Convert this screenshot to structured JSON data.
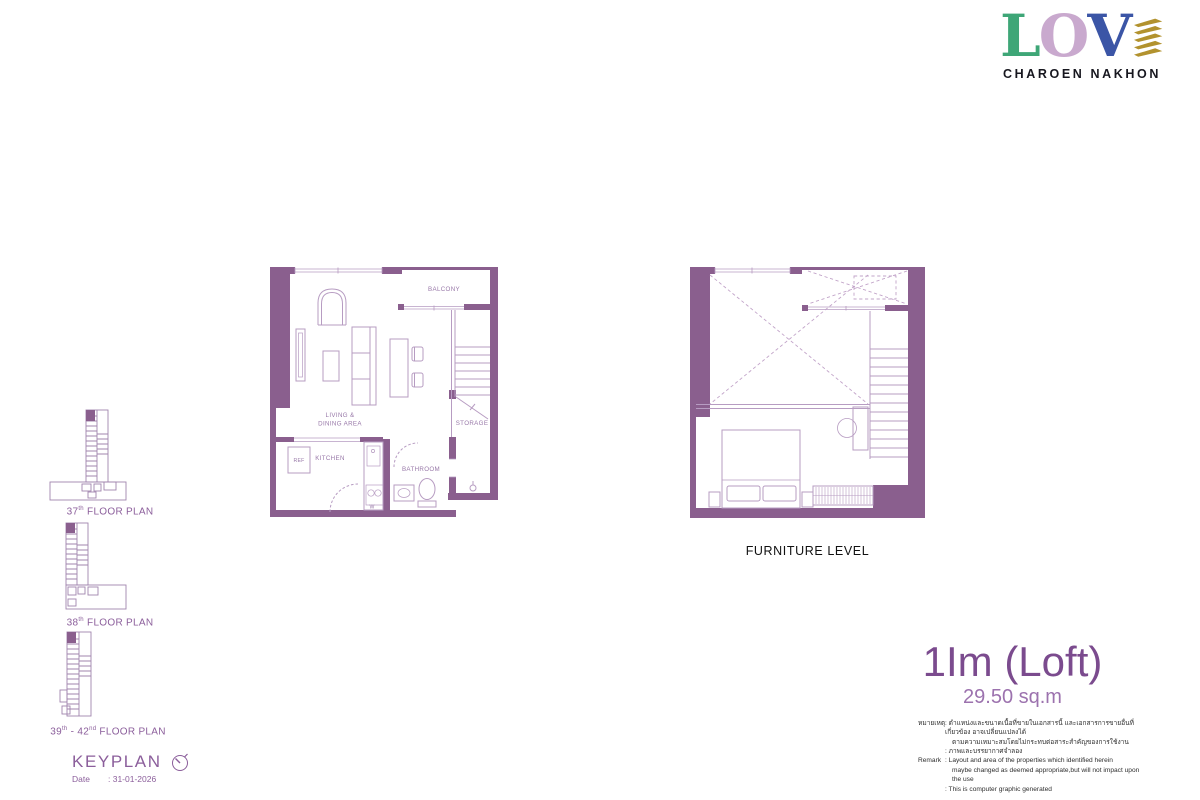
{
  "logo": {
    "letters": [
      {
        "char": "L",
        "color": "#3EA677"
      },
      {
        "char": "O",
        "color": "#C9A9CE"
      },
      {
        "char": "V",
        "color": "#3B55A6"
      }
    ],
    "leaf_color": "#B2922E",
    "subtitle": "CHAROEN NAKHON"
  },
  "unit_plan": {
    "wall_color": "#8A5F8E",
    "line_color": "#B79CC2",
    "labels": {
      "balcony": "BALCONY",
      "living_line1": "LIVING &",
      "living_line2": "DINING AREA",
      "storage": "STORAGE",
      "kitchen": "KITCHEN",
      "ref": "REF",
      "washer": "W",
      "bathroom": "BATHROOM"
    }
  },
  "furniture_plan": {
    "caption": "FURNITURE LEVEL"
  },
  "keyplans": [
    {
      "parts": [
        {
          "text": "37"
        },
        {
          "text": "th"
        },
        {
          "text": " FLOOR PLAN"
        }
      ]
    },
    {
      "parts": [
        {
          "text": "38"
        },
        {
          "text": "th"
        },
        {
          "text": " FLOOR PLAN"
        }
      ]
    },
    {
      "parts": [
        {
          "text": "39"
        },
        {
          "text": "th"
        },
        {
          "text": " - 42"
        },
        {
          "text": "nd"
        },
        {
          "text": " FLOOR PLAN"
        }
      ]
    }
  ],
  "keyplan_footer": {
    "title": "KEYPLAN",
    "date_label": "Date",
    "date_value": ": 31-01-2026"
  },
  "unit_info": {
    "name": "1Im (Loft)",
    "area": "29.50 sq.m",
    "name_color": "#7B4B8E"
  },
  "remark": {
    "rows": [
      {
        "label": "หมายเหตุ",
        "text": ": ตำแหน่งและขนาดเนื้อที่ขายในเอกสารนี้ และเอกสารการขายอื่นที่เกี่ยวข้อง อาจเปลี่ยนแปลงได้"
      },
      {
        "label": "",
        "text": "ตามความเหมาะสมโดยไม่กระทบต่อสาระสำคัญของการใช้งาน"
      },
      {
        "label": "",
        "text": ": ภาพและบรรยากาศจำลอง"
      },
      {
        "label": "Remark",
        "text": ": Layout and area of the properties which identified herein"
      },
      {
        "label": "",
        "text": "maybe changed as deemed appropriate,but will not impact upon the use"
      },
      {
        "label": "",
        "text": ": This is computer graphic generated"
      }
    ]
  }
}
